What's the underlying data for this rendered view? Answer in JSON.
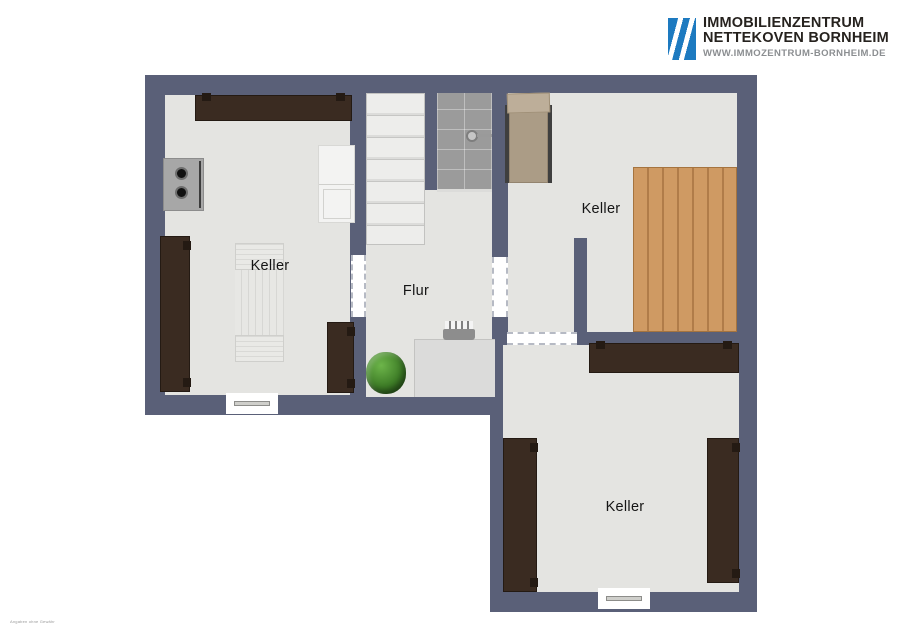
{
  "branding": {
    "line1": "IMMOBILIENZENTRUM",
    "line2": "NETTEKOVEN BORNHEIM",
    "line3": "WWW.IMMOZENTRUM-BORNHEIM.DE",
    "logo_color": "#1d7ac0"
  },
  "plan": {
    "type": "basement-floorplan",
    "rooms": [
      {
        "id": "keller-left",
        "label": "Keller"
      },
      {
        "id": "flur",
        "label": "Flur"
      },
      {
        "id": "keller-top-right",
        "label": "Keller"
      },
      {
        "id": "keller-bottom-right",
        "label": "Keller"
      }
    ],
    "features": [
      "staircase",
      "shower",
      "desk-with-chair",
      "plant",
      "lounger",
      "wood-platform",
      "washer-appliance",
      "wardrobes",
      "sideboards",
      "windows",
      "sliding-doors"
    ]
  },
  "fineprint": "Angaben ohne Gewähr",
  "colors": {
    "wall": "#5a6078",
    "floor": "#e4e4e1",
    "dark_wood": "#3a2b21",
    "platform_wood": "#cf9a63",
    "tile": "#9b9b9b",
    "lounger_fabric": "#b1a28d",
    "plant_green": "#3e7d27",
    "logo_blue": "#1d7ac0"
  }
}
